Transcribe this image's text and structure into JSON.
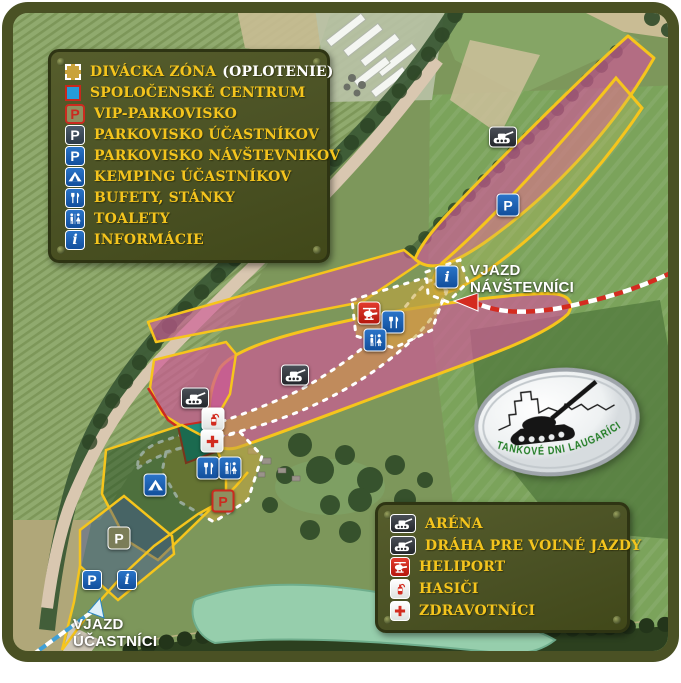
{
  "legend_main": {
    "items": [
      {
        "label": "DIVÁCKA ZÓNA",
        "suffix": "(OPLOTENIE)",
        "icon": "spectator-zone-swatch"
      },
      {
        "label": "SPOLOČENSKÉ CENTRUM",
        "icon": "social-center-swatch"
      },
      {
        "label": "VIP-PARKOVISKO",
        "icon": "vip-parking"
      },
      {
        "label": "PARKOVISKO ÚČASTNÍKOV",
        "icon": "participants-parking"
      },
      {
        "label": "PARKOVISKO NÁVŠTEVNIKOV",
        "icon": "visitors-parking"
      },
      {
        "label": "KEMPING ÚČASTNÍKOV",
        "icon": "camping"
      },
      {
        "label": "BUFETY, STÁNKY",
        "icon": "food-stalls"
      },
      {
        "label": "TOALETY",
        "icon": "toilets"
      },
      {
        "label": "INFORMÁCIE",
        "icon": "information"
      }
    ]
  },
  "legend_bottom": {
    "items": [
      {
        "label": "ARÉNA",
        "icon": "tank"
      },
      {
        "label": "DRÁHA PRE VOĽNÉ JAZDY",
        "icon": "tank"
      },
      {
        "label": "HELIPORT",
        "icon": "helicopter"
      },
      {
        "label": "HASIČI",
        "icon": "fire-extinguisher"
      },
      {
        "label": "ZDRAVOTNÍCI",
        "icon": "medical-cross"
      }
    ]
  },
  "map_labels": {
    "visitors_entrance": "VJAZD\nNÁVŠTEVNÍCI",
    "participants_entrance": "VJAZD\nÚČASTNÍCI"
  },
  "logo": {
    "text": "TANKOVÉ DNI LAUGARÍCIO"
  },
  "colors": {
    "legend_olive": "#4a5124",
    "accent_yellow": "#f6c51c",
    "zone_pink": "#cd5a96",
    "zone_ochre": "#c9a33b",
    "social_center_teal": "#1f8d7c",
    "route_red": "#d42b20",
    "route_blue": "#3fa0d8",
    "label_white": "#ffffff"
  }
}
